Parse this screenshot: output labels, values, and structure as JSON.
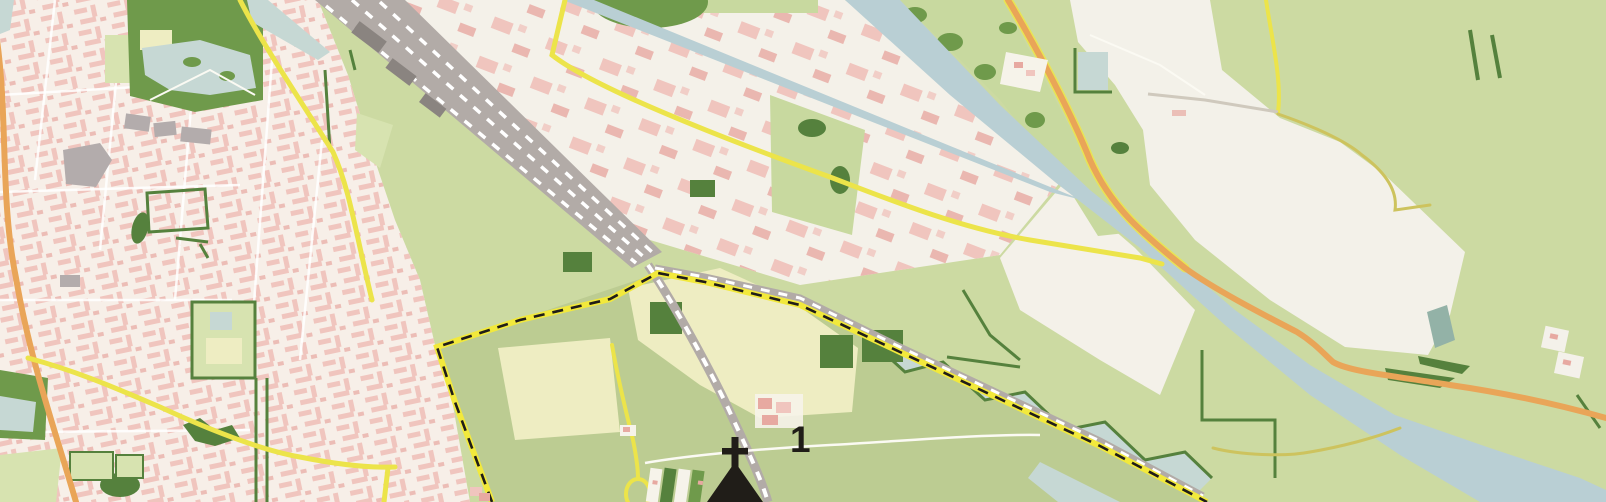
{
  "map": {
    "title": "Topographic map excerpt",
    "marker": {
      "label": "1"
    },
    "symbols": [
      {
        "name": "church-with-tower-icon",
        "description": "black cross above spire silhouette"
      },
      {
        "name": "area-boundary",
        "style": "yellow band with black dashes"
      }
    ],
    "features": [
      "residential-area-west",
      "industrial-strip-along-canal",
      "city-park-with-pond",
      "canal",
      "canal-junction",
      "railway-yard",
      "railway-line-south",
      "railway-line-east",
      "protected-area-boundary",
      "farm-fields",
      "garden-plots",
      "wetland-strip",
      "recreation-area-white",
      "motor-road-orange",
      "secondary-road-yellow",
      "roundabout"
    ]
  },
  "colors": {
    "base": "#ccdaa2",
    "field_protected": "#bccc92",
    "field_bright": "#c8d99f",
    "field_pale": "#d7e3b0",
    "urban": "#f7efe8",
    "building_pink": "#f0c5be",
    "building_pink_dark": "#e7a9a1",
    "industrial_white": "#f4f1e9",
    "open_white": "#f3f1e9",
    "park_green": "#6f9a4b",
    "hedge_green": "#55813d",
    "water": "#b9cfd4",
    "water_light": "#c6d8d4",
    "road_yellow": "#ece44a",
    "road_orange": "#e9a558",
    "road_olive": "#cdc35e",
    "railway_gray": "#b2aba7",
    "railway_dark": "#8a8480",
    "boundary_yellow": "#f2e93c",
    "ink": "#201d18",
    "gray_building": "#b3acac",
    "cream": "#eeedc2",
    "path_white": "#fbfaf3"
  }
}
